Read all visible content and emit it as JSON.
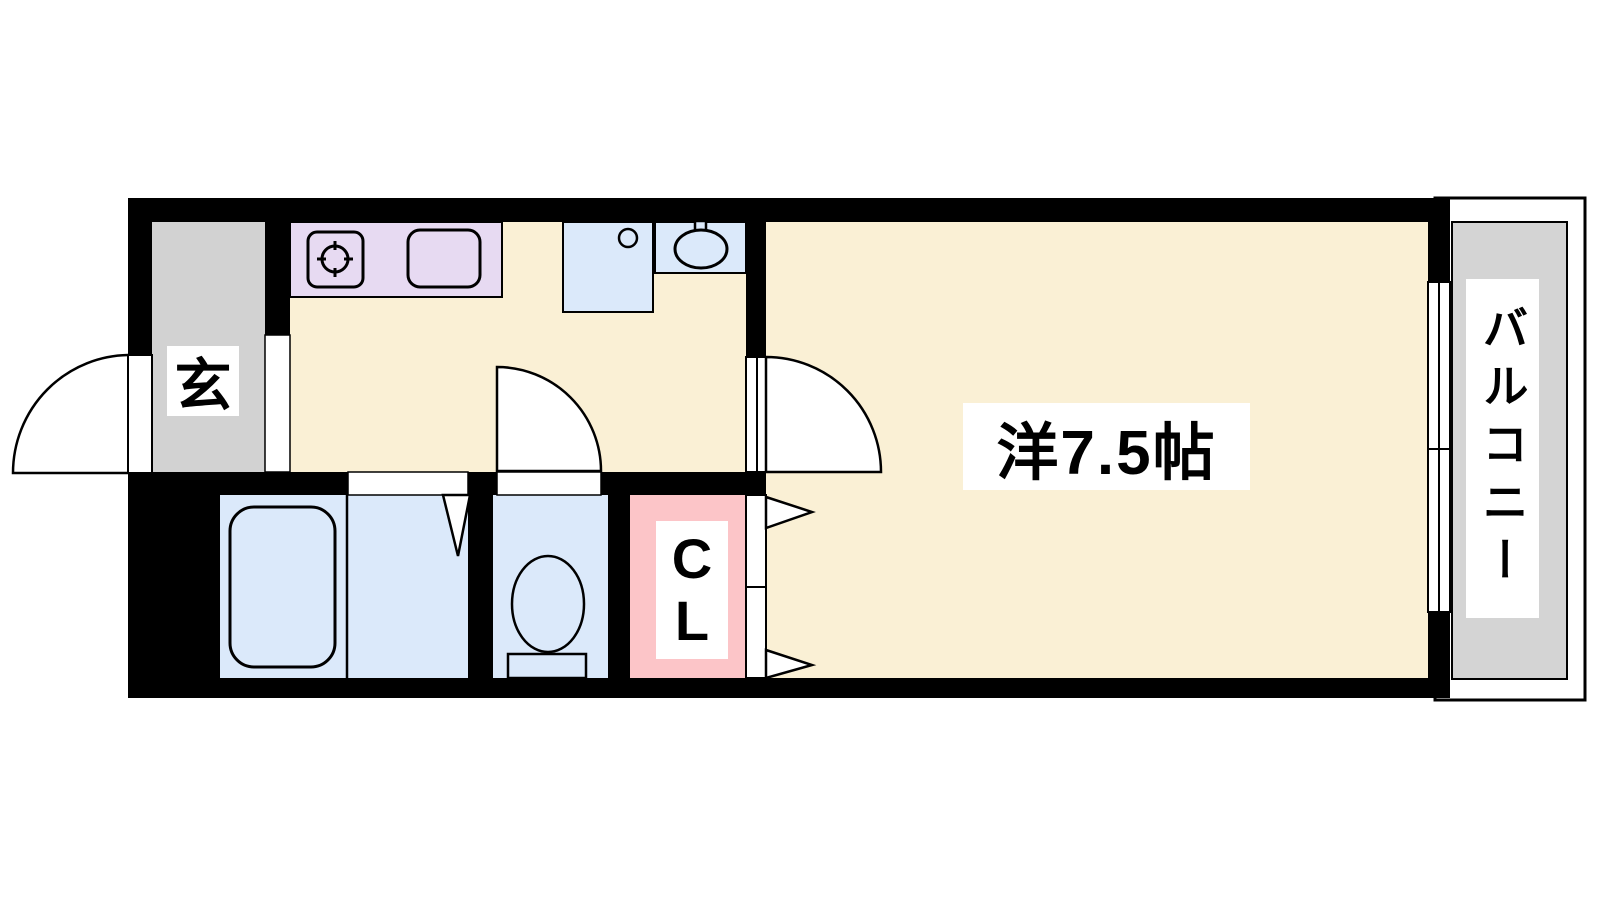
{
  "floorplan": {
    "labels": {
      "entrance": "玄",
      "main_room": "洋7.5帖",
      "closet_lines": [
        "C",
        "L"
      ],
      "balcony": "バルコニー"
    },
    "colors": {
      "wall": "#000000",
      "room_floor": "#FAF0D5",
      "kitchen_counter": "#E7DAF2",
      "water_fixture": "#DBE9FA",
      "entrance_floor": "#D2D2D2",
      "balcony_floor": "#D4D4D4",
      "closet": "#FCC5C8"
    }
  }
}
